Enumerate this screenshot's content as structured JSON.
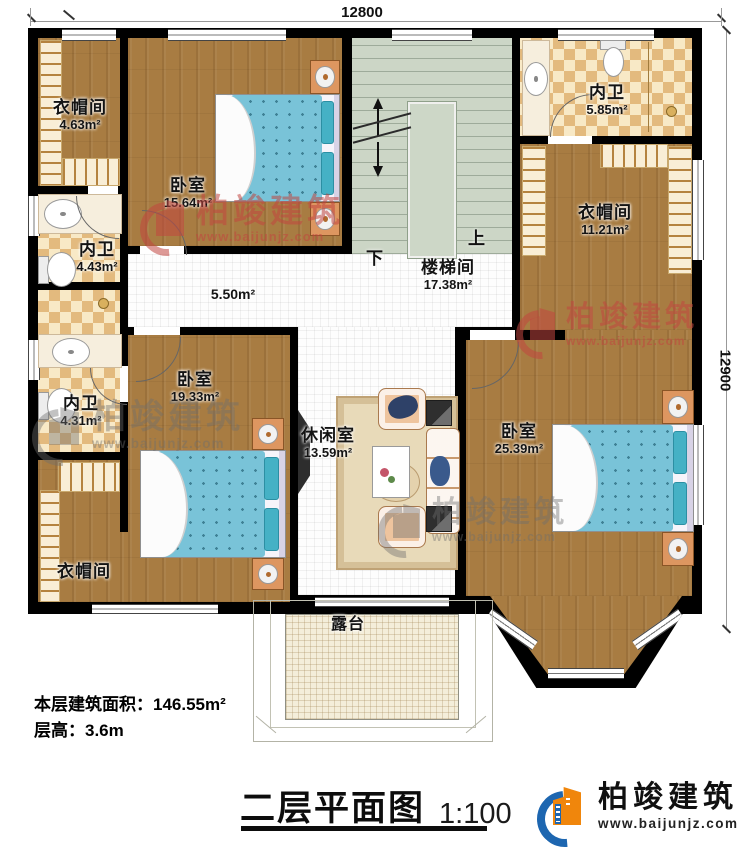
{
  "dimensions": {
    "top": "12800",
    "right": "12900"
  },
  "rooms": {
    "cloak_tl": {
      "name": "衣帽间",
      "area": "4.63m²"
    },
    "bed_tl": {
      "name": "卧室",
      "area": "15.64m²"
    },
    "stairwell": {
      "name": "楼梯间",
      "area": "17.38m²"
    },
    "bath_tr": {
      "name": "内卫",
      "area": "5.85m²"
    },
    "cloak_tr": {
      "name": "衣帽间",
      "area": "11.21m²"
    },
    "bath_l1": {
      "name": "内卫",
      "area": "4.43m²"
    },
    "bath_l2": {
      "name": "内卫",
      "area": "4.31m²"
    },
    "corridor": {
      "area": "5.50m²"
    },
    "bed_bl": {
      "name": "卧室",
      "area": "19.33m²"
    },
    "leisure": {
      "name": "休闲室",
      "area": "13.59m²"
    },
    "bed_r": {
      "name": "卧室",
      "area": "25.39m²"
    },
    "cloak_bl": {
      "name": "衣帽间"
    },
    "terrace": {
      "name": "露台"
    }
  },
  "stairs": {
    "up": "上",
    "down": "下"
  },
  "info": {
    "area_line": "本层建筑面积：146.55m²",
    "height_line": "层高：3.6m"
  },
  "title": {
    "name": "二层平面图",
    "scale": "1:100"
  },
  "brand": {
    "name": "柏竣建筑",
    "url": "www.baijunjz.com"
  },
  "watermark": {
    "name": "柏竣建筑",
    "url": "www.baijunjz.com"
  },
  "colors": {
    "wall": "#000000",
    "wood_floor": "#a87c42",
    "bath_tile": "#e3ba7e",
    "stairs": "#ccd6c6",
    "bed_blue": "#79c3d8",
    "logo_blue": "#1d66b0",
    "logo_orange": "#f0860c",
    "watermark_red": "#c14640"
  }
}
